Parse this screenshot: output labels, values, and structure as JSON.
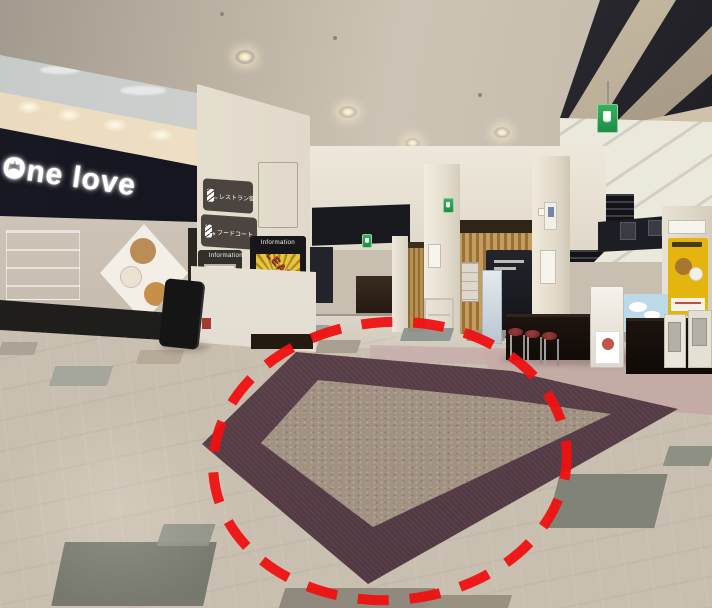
{
  "scene": {
    "description": "shopping mall interior photo",
    "annotation": {
      "shape": "dashed-ellipse",
      "color": "#ef1111"
    }
  },
  "signs": {
    "store_name": "One love",
    "direction_left": "レストラン街",
    "direction_right": "フードコート",
    "info_header_left": "Information",
    "info_header_front": "Information",
    "clearance_poster": "CLEARANCE"
  },
  "colors": {
    "annotation_red": "#ef1111",
    "carpet_border_purple": "#5a4049",
    "carpet_center_tan": "#a29283",
    "floor_beige": "#cdc3b2",
    "fascia_black": "#13141b",
    "poster_yellow": "#e7c53b",
    "exit_green": "#2ea24e",
    "character_poster_yellow": "#e5b50f"
  }
}
